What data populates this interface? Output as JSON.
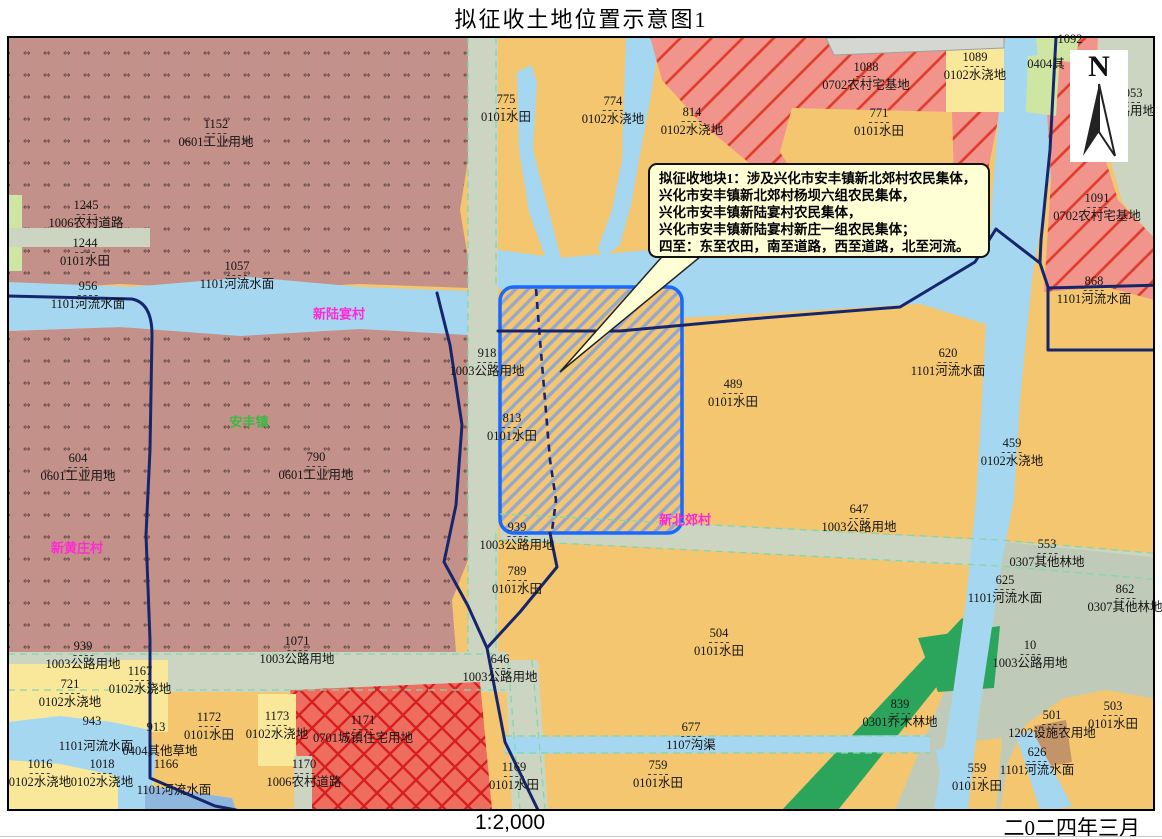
{
  "title": "拟征收土地位置示意图1",
  "scale_text": "1:2,000",
  "date_text": "二0二四年三月",
  "north_label": "N",
  "callout": {
    "title": "拟征收地块1：",
    "lines": [
      "涉及兴化市安丰镇新北郊村农民集体，",
      "兴化市安丰镇新北郊村杨坝六组农民集体，",
      "兴化市安丰镇新陆宴村农民集体，",
      "兴化市安丰镇新陆宴村新庄一组农民集体；",
      "四至：东至农田，南至道路，西至道路，北至河流。"
    ]
  },
  "map": {
    "place_labels": [
      {
        "text": "新陆宴村",
        "x": 339,
        "y": 313,
        "color": "#ff2ad4"
      },
      {
        "text": "安丰镇",
        "x": 249,
        "y": 421,
        "color": "#3cb844"
      },
      {
        "text": "新黄庄村",
        "x": 77,
        "y": 547,
        "color": "#ff2ad4"
      },
      {
        "text": "新北郊村",
        "x": 685,
        "y": 519,
        "color": "#ff2ad4"
      }
    ],
    "parcel_labels": [
      {
        "n": "1152",
        "t": "0601工业用地",
        "x": 216,
        "y": 124
      },
      {
        "n": "1245",
        "t": "1006农村道路",
        "x": 86,
        "y": 205
      },
      {
        "n": "1244",
        "t": "0101水田",
        "x": 85,
        "y": 243
      },
      {
        "n": "956",
        "t": "1101河流水面",
        "x": 88,
        "y": 286
      },
      {
        "n": "1057",
        "t": "1101河流水面",
        "x": 237,
        "y": 266
      },
      {
        "n": "775",
        "t": "0101水田",
        "x": 506,
        "y": 99
      },
      {
        "n": "774",
        "t": "0102水浇地",
        "x": 613,
        "y": 101
      },
      {
        "n": "814",
        "t": "0102水浇地",
        "x": 692,
        "y": 112
      },
      {
        "n": "1088",
        "t": "0702农村宅基地",
        "x": 866,
        "y": 67
      },
      {
        "n": "771",
        "t": "0101水田",
        "x": 879,
        "y": 113
      },
      {
        "n": "1089",
        "t": "0102水浇地",
        "x": 975,
        "y": 57
      },
      {
        "n": "1092",
        "t": "",
        "x": 1070,
        "y": 39
      },
      {
        "n": "",
        "t": "0404其",
        "x": 1046,
        "y": 64
      },
      {
        "n": "1053",
        "t": "公路用地",
        "x": 1130,
        "y": 93
      },
      {
        "n": "1091",
        "t": "0702农村宅基地",
        "x": 1097,
        "y": 198
      },
      {
        "n": "868",
        "t": "1101河流水面",
        "x": 1094,
        "y": 281
      },
      {
        "n": "604",
        "t": "0601工业用地",
        "x": 78,
        "y": 458
      },
      {
        "n": "790",
        "t": "0601工业用地",
        "x": 316,
        "y": 457
      },
      {
        "n": "918",
        "t": "1003公路用地",
        "x": 487,
        "y": 353
      },
      {
        "n": "813",
        "t": "0101水田",
        "x": 512,
        "y": 418
      },
      {
        "n": "489",
        "t": "0101水田",
        "x": 733,
        "y": 384
      },
      {
        "n": "620",
        "t": "1101河流水面",
        "x": 948,
        "y": 353
      },
      {
        "n": "459",
        "t": "0102水浇地",
        "x": 1012,
        "y": 443
      },
      {
        "n": "647",
        "t": "1003公路用地",
        "x": 859,
        "y": 509
      },
      {
        "n": "939",
        "t": "1003公路用地",
        "x": 517,
        "y": 527
      },
      {
        "n": "789",
        "t": "0101水田",
        "x": 517,
        "y": 571
      },
      {
        "n": "1071",
        "t": "1003公路用地",
        "x": 297,
        "y": 641
      },
      {
        "n": "939",
        "t": "1003公路用地",
        "x": 83,
        "y": 646
      },
      {
        "n": "721",
        "t": "0102水浇地",
        "x": 70,
        "y": 684
      },
      {
        "n": "1167",
        "t": "0102水浇地",
        "x": 140,
        "y": 671
      },
      {
        "n": "943",
        "t": "",
        "x": 92,
        "y": 721
      },
      {
        "n": "",
        "t": "1101河流水面",
        "x": 96,
        "y": 746
      },
      {
        "n": "913",
        "t": "",
        "x": 156,
        "y": 727
      },
      {
        "n": "",
        "t": "0404其他草地",
        "x": 160,
        "y": 751
      },
      {
        "n": "1166",
        "t": "",
        "x": 166,
        "y": 764
      },
      {
        "n": "1016",
        "t": "0102水浇地",
        "x": 40,
        "y": 764
      },
      {
        "n": "1018",
        "t": "0102水浇地",
        "x": 102,
        "y": 764
      },
      {
        "n": "",
        "t": "1101河流水面",
        "x": 174,
        "y": 790
      },
      {
        "n": "1172",
        "t": "0101水田",
        "x": 209,
        "y": 717
      },
      {
        "n": "1173",
        "t": "0102水浇地",
        "x": 277,
        "y": 716
      },
      {
        "n": "1171",
        "t": "0701城镇住宅用地",
        "x": 363,
        "y": 720
      },
      {
        "n": "1170",
        "t": "1006农村道路",
        "x": 304,
        "y": 764
      },
      {
        "n": "646",
        "t": "1003公路用地",
        "x": 500,
        "y": 659
      },
      {
        "n": "1169",
        "t": "0101水田",
        "x": 514,
        "y": 767
      },
      {
        "n": "504",
        "t": "0101水田",
        "x": 719,
        "y": 633
      },
      {
        "n": "677",
        "t": "1107沟渠",
        "x": 691,
        "y": 727
      },
      {
        "n": "759",
        "t": "0101水田",
        "x": 658,
        "y": 765
      },
      {
        "n": "839",
        "t": "0301乔木林地",
        "x": 900,
        "y": 704
      },
      {
        "n": "553",
        "t": "0307其他林地",
        "x": 1047,
        "y": 544
      },
      {
        "n": "625",
        "t": "1101河流水面",
        "x": 1005,
        "y": 580
      },
      {
        "n": "862",
        "t": "0307其他林地",
        "x": 1125,
        "y": 589
      },
      {
        "n": "10",
        "t": "1003公路用地",
        "x": 1030,
        "y": 645
      },
      {
        "n": "501",
        "t": "1202设施农用地",
        "x": 1052,
        "y": 715
      },
      {
        "n": "503",
        "t": "0101水田",
        "x": 1113,
        "y": 706
      },
      {
        "n": "626",
        "t": "1101河流水面",
        "x": 1037,
        "y": 752
      },
      {
        "n": "559",
        "t": "0101水田",
        "x": 977,
        "y": 768
      }
    ],
    "colors": {
      "paddy_field_0101": "#f3c66f",
      "irrigated_land_0102": "#f9e89a",
      "river_water_1101": "#a6d7f0",
      "road_land_1003": "#ccd4c2",
      "industrial_0601": "#c4918a",
      "rural_homestead_0702": "#f1948c",
      "urban_residential_0701": "#ed6a5c",
      "arbor_forest_0301": "#2ba55c",
      "other_forest_0307": "#bfcbb8",
      "other_grass_0404": "#cfe6a3",
      "facility_agriculture_1202": "#c49469",
      "acquisition_parcel_border": "#1769ff",
      "boundary_line": "#16266d",
      "village_label": "#ff2ad4",
      "town_label": "#3cb844",
      "callout_background": "#ffffd6"
    }
  }
}
